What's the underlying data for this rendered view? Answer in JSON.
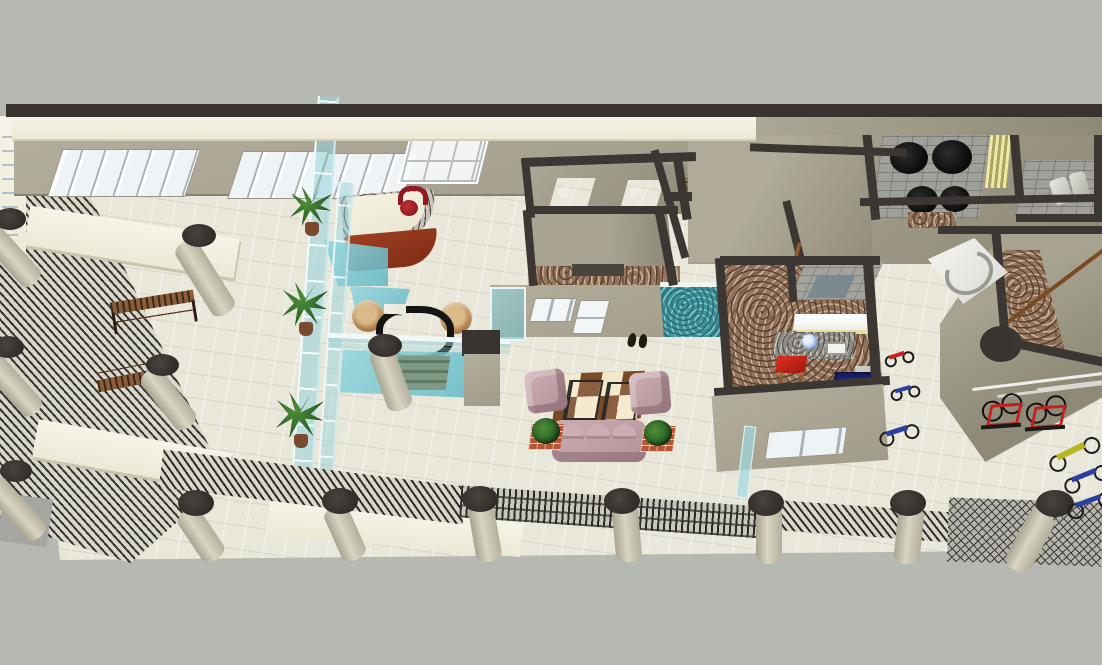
{
  "scene": {
    "label": "3D rendered cutaway floor plan of a commercial building lobby, viewed from above at an angle",
    "type": "3d-floorplan-render",
    "background_color": "#b6b8b2",
    "palette": {
      "wall_cap_dark": "#3c3733",
      "wall_taupe": "#9c9784",
      "fascia_cream": "#f3f1e3",
      "floor_tile": "#e9e7da",
      "floor_granite_brown": "#96755e",
      "counter_granite_gray": "#8f8d86",
      "glass_aqua": "#7fc6ce",
      "pool_mosaic_teal": "#3f9098",
      "sofa_mauve": "#c0a1a7",
      "rug_brown": "#7b4a26",
      "rug_cream": "#f2e8ca",
      "wicker_tan": "#c99a62",
      "bench_wood": "#8a5a3a",
      "desk_front_red_brown": "#8e3520",
      "chair_red": "#9e1b20",
      "bike_red": "#c82020",
      "bike_blue": "#2b3f9e",
      "bike_yellow": "#b5b81e",
      "cabinet_navy": "#16195f",
      "plant_green": "#2c6326",
      "column_dark_top": "#352f2c",
      "column_body": "#cac6b4"
    },
    "areas": [
      {
        "name": "entry-lobby",
        "objects": [
          "reception-desk",
          "reception-chair",
          "glass-atrium-wall",
          "glass-canopy",
          "potted-palms",
          "reflecting-pools"
        ]
      },
      {
        "name": "lounge",
        "objects": [
          "wicker-chair",
          "wicker-chair",
          "tube-coffee-table",
          "water-feature-steps",
          "glass-balcony-rail"
        ]
      },
      {
        "name": "living-area",
        "objects": [
          "checkered-rug",
          "glass-side-tables",
          "armchairs",
          "three-seat-sofa",
          "brick-planters"
        ]
      },
      {
        "name": "west-terrace",
        "objects": [
          "wood-benches",
          "louvered-facade",
          "cream-canopies",
          "leaning-columns"
        ]
      },
      {
        "name": "center-rooms",
        "objects": [
          "partition-walls",
          "granite-floors",
          "white-windows",
          "mosaic-pool",
          "white-ledge",
          "shoes"
        ]
      },
      {
        "name": "kitchen",
        "objects": [
          "overhead-cabinet",
          "granite-counter",
          "sink",
          "red-table",
          "navy-cabinet",
          "range-hood-panel",
          "south-window",
          "glass-fin"
        ]
      },
      {
        "name": "northeast-rooms",
        "objects": [
          "black-fixtures",
          "brick-tile-floors",
          "yellow-striped-door",
          "washroom-fixtures"
        ]
      },
      {
        "name": "east-wing",
        "objects": [
          "curved-white-counter",
          "granite-path",
          "wood-handrail",
          "corner-wall"
        ]
      },
      {
        "name": "bike-court",
        "objects": [
          "small-red-bike",
          "small-blue-bikes",
          "rack-red-bikes",
          "bike-rack-rail",
          "yellow-bike",
          "blue-bikes-right",
          "drain-grate"
        ]
      },
      {
        "name": "south-colonnade",
        "objects": [
          "louver-railing-bands",
          "columns-row",
          "cream-slab-edge"
        ]
      }
    ],
    "column_count": 13,
    "window_pane_groups": 3
  }
}
